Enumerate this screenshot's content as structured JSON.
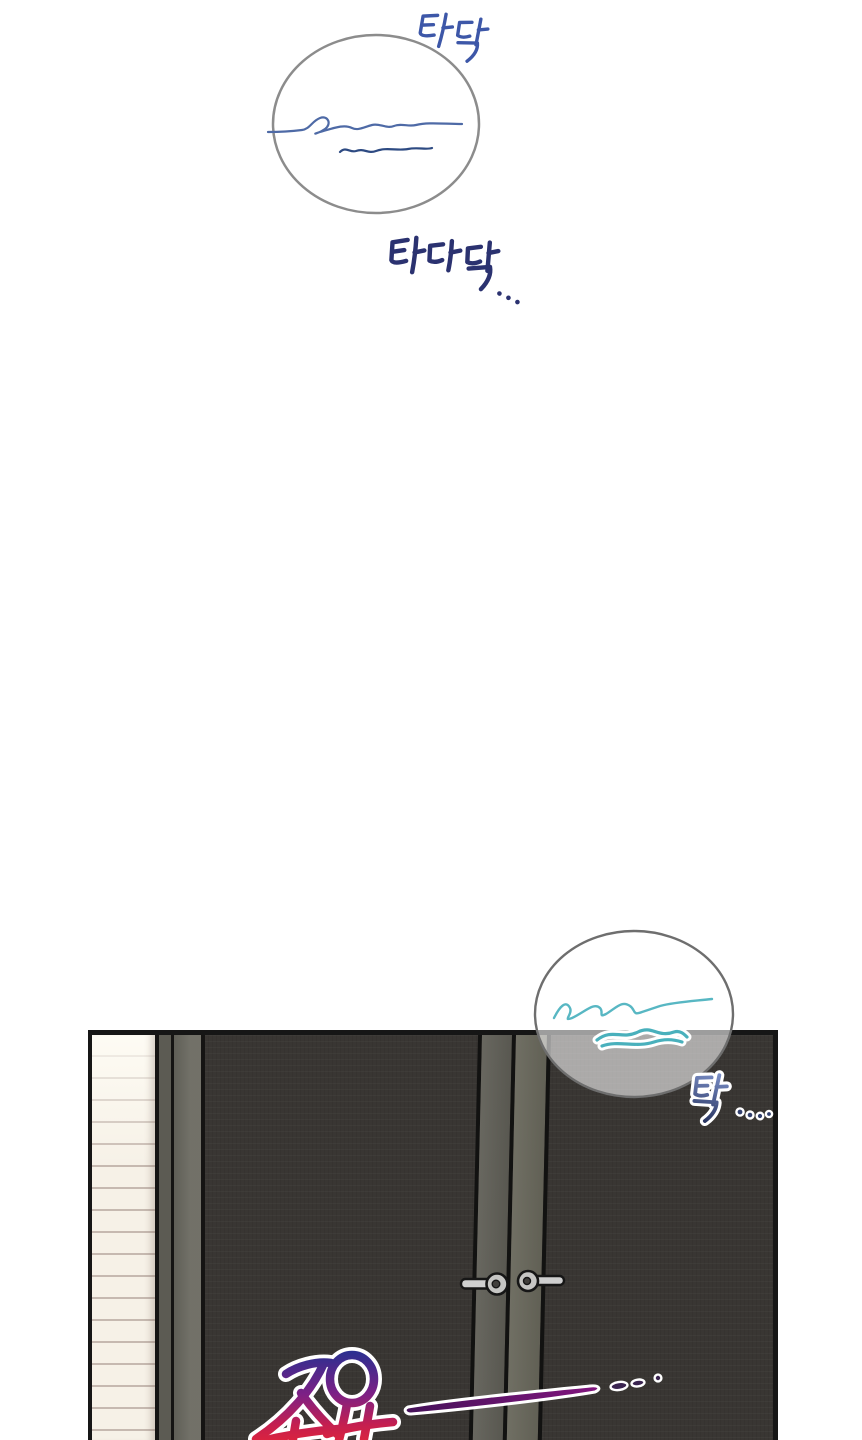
{
  "canvas": {
    "width": 862,
    "height": 1440,
    "background": "#ffffff"
  },
  "top_section": {
    "thought_bubble": {
      "shape": "hand-drawn oval",
      "border_color": "#8c8c8c",
      "fill": "#ffffff",
      "content_desc": "illegible handwritten scribble lines",
      "scribble_colors": [
        "#4e6aa6",
        "#2d4a82"
      ]
    },
    "sfx_top_right": {
      "text": "타닥",
      "color": "#3d57a8"
    },
    "sfx_below_bubble": {
      "text": "타다닥...",
      "color": "#2b3270"
    }
  },
  "panel": {
    "scene_desc": "dark double wardrobe doors beside a striped cream wall strip",
    "border_color": "#161616",
    "door_color": "#393633",
    "wall_strip": {
      "fill": "#f6f1e7",
      "line_color": "#c6b9b0"
    },
    "frame_strip_colors": [
      "#5c5b53",
      "#6a6960"
    ],
    "center_stile_colors": [
      "#605f57",
      "#67665a"
    ],
    "handles": {
      "count": 2,
      "style": "lever",
      "metal_color": "#cfcfcf",
      "outline_color": "#161616"
    },
    "overlay_bubble": {
      "shape": "hand-drawn oval",
      "border_color": "#6e6e6e",
      "fill": "rgba(255,255,255,0.58)",
      "content_desc": "illegible handwritten teal scribble",
      "scribble_color": "#58b7c3",
      "scribble_outline": "#ffffff"
    },
    "sfx_tak": {
      "text": "탁....",
      "gradient": [
        "#7a8ec6",
        "#27335f"
      ],
      "outline": "#ffffff"
    },
    "sfx_quiet": {
      "text": "조용 —...",
      "gradient": [
        "#2c2f90",
        "#7c2086",
        "#e0243a"
      ],
      "outline": "#ffffff"
    }
  }
}
